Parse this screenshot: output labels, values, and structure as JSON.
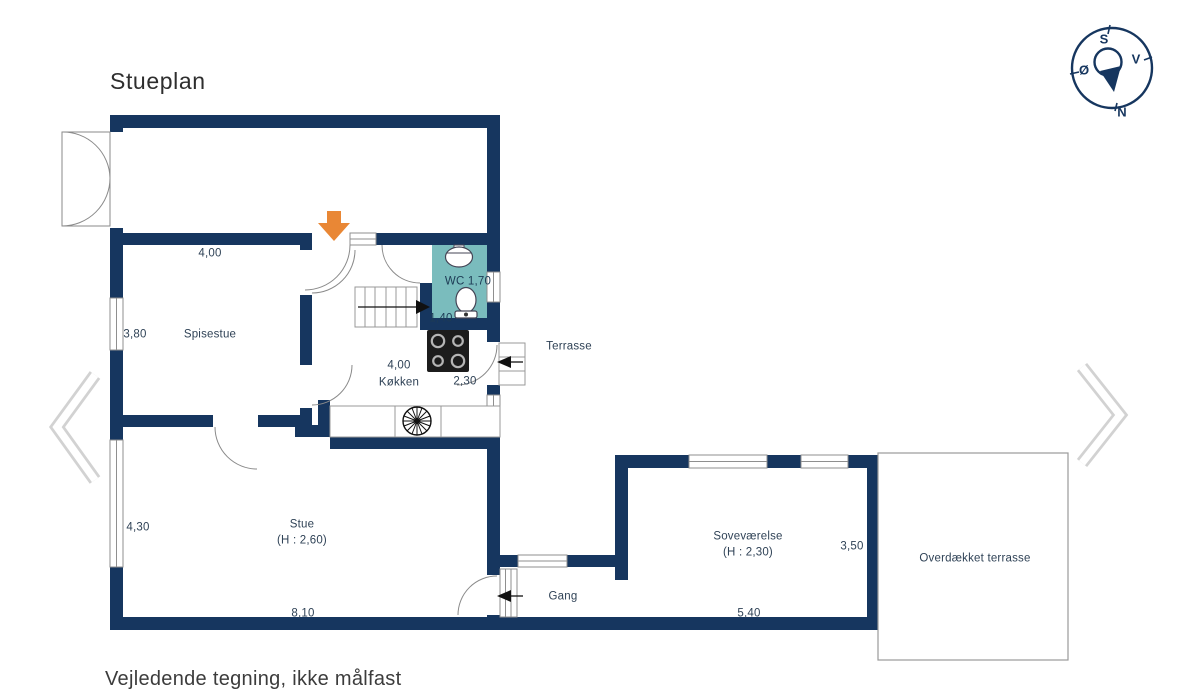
{
  "page": {
    "title": "Stueplan",
    "footer_note": "Vejledende tegning, ikke målfast"
  },
  "compass": {
    "top": "S",
    "right": "V",
    "left": "Ø",
    "bottom": "N"
  },
  "nav": {
    "prev_icon": "chevron-left",
    "next_icon": "chevron-right"
  },
  "colors": {
    "wall": "#16365f",
    "wc_fill": "#7abcbd",
    "entrance_arrow": "#e98735"
  },
  "rooms": {
    "spisestue": {
      "label": "Spisestue",
      "dim_top": "4,00",
      "dim_left": "3,80"
    },
    "wc": {
      "label": "WC 1,70",
      "dim": "1,40"
    },
    "koekken": {
      "label": "Køkken",
      "dim_top": "4,00",
      "dim_right": "2,30"
    },
    "terrasse": {
      "label": "Terrasse"
    },
    "stue": {
      "label": "Stue",
      "height_note": "(H : 2,60)",
      "dim_left": "4,30",
      "dim_bottom": "8,10"
    },
    "gang": {
      "label": "Gang"
    },
    "sovevaerelse": {
      "label": "Soveværelse",
      "height_note": "(H : 2,30)",
      "dim_right": "3,50",
      "dim_bottom": "5,40"
    },
    "overdaekket_terrasse": {
      "label": "Overdækket terrasse"
    }
  }
}
